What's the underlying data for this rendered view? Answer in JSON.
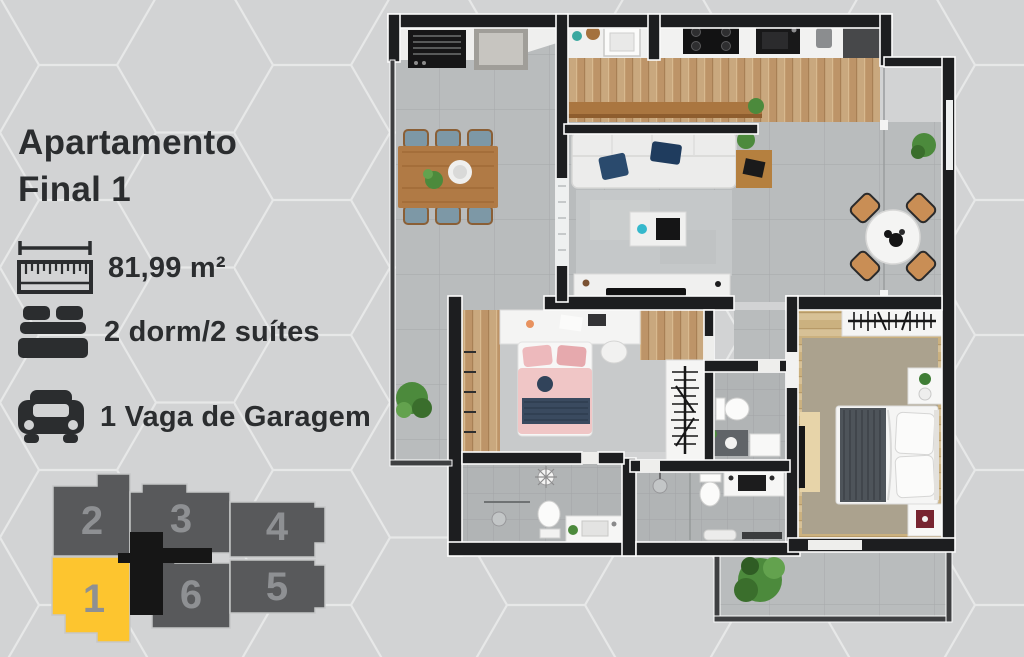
{
  "panel": {
    "title_line1": "Apartamento",
    "title_line2": "Final 1",
    "specs": [
      {
        "icon": "ruler-icon",
        "label": "81,99 m²"
      },
      {
        "icon": "bed-icon",
        "label": "2 dorm/2 suítes"
      },
      {
        "icon": "car-icon",
        "label": "1 Vaga de Garagem"
      }
    ]
  },
  "keyplan": {
    "highlighted_unit": "1",
    "units": [
      {
        "number": "2",
        "highlighted": false
      },
      {
        "number": "3",
        "highlighted": false
      },
      {
        "number": "4",
        "highlighted": false
      },
      {
        "number": "1",
        "highlighted": true
      },
      {
        "number": "6",
        "highlighted": false
      },
      {
        "number": "5",
        "highlighted": false
      }
    ]
  },
  "colors": {
    "background": "#d2d3d4",
    "hex_line": "#e7e8e8",
    "accent_yellow": "#fdc52f",
    "block_gray": "#58595b",
    "core_black": "#161616",
    "number_gray": "#8e9093",
    "text_dark": "#2b2d2f",
    "wall_black": "#1d1e20"
  }
}
